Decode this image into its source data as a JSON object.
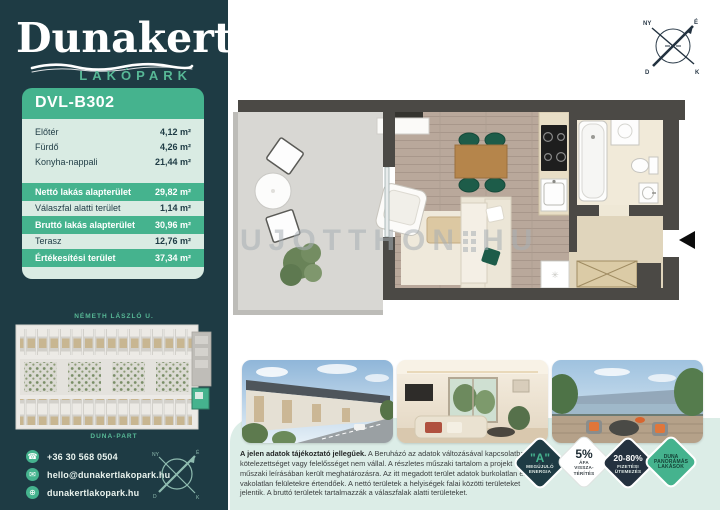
{
  "brand": {
    "name": "Dunakert",
    "subtitle": "LAKÓPARK"
  },
  "unit": {
    "code": "DVL-B302"
  },
  "area_table": {
    "rooms": [
      {
        "label": "Előtér",
        "value": "4,12 m²"
      },
      {
        "label": "Fürdő",
        "value": "4,26 m²"
      },
      {
        "label": "Konyha-nappali",
        "value": "21,44 m²"
      }
    ],
    "summary": [
      {
        "label": "Nettó lakás alapterület",
        "value": "29,82 m²",
        "highlight": true
      },
      {
        "label": "Válaszfal alatti terület",
        "value": "1,14 m²",
        "highlight": false
      },
      {
        "label": "Bruttó lakás alapterület",
        "value": "30,96 m²",
        "highlight": true
      },
      {
        "label": "Terasz",
        "value": "12,76 m²",
        "highlight": false
      },
      {
        "label": "Értékesítési terület",
        "value": "37,34 m²",
        "highlight": true
      }
    ]
  },
  "site_plan": {
    "street_top": "NÉMETH LÁSZLÓ U.",
    "street_bottom": "DUNA-PART"
  },
  "contact": {
    "phone": "+36 30 568 0504",
    "email": "hello@dunakertlakopark.hu",
    "website": "dunakertlakopark.hu"
  },
  "compass": {
    "north": "É",
    "south": "D",
    "east": "K",
    "west": "NY"
  },
  "floor_plan": {
    "watermark": "UJOTTHON",
    "watermark_suffix": "HU"
  },
  "disclaimer": {
    "lead": "A jelen adatok tájékoztató jellegűek.",
    "body": " A Beruházó az adatok változásával kapcsolatban kötelezettséget vagy felelősséget nem vállal. A részletes műszaki tartalom a projekt műszaki leírásában került meghatározásra. Az itt megadott terület adatok burkolatlan és vakolatlan felületekre értendőek. A nettó területek a helyiségek falai közötti területeket jelentik. A bruttó területek tartalmazzák a válaszfalak alatti területeket."
  },
  "badges": [
    {
      "line1": "\"A\"",
      "line2": "MEGÚJULÓ",
      "line3": "ENERGIA"
    },
    {
      "line1": "5%",
      "line2": "ÁFA",
      "line3": "VISSZA-TÉRÍTÉS"
    },
    {
      "line1": "20-80%",
      "line2": "FIZETÉSI",
      "line3": "ÜTEMEZÉS"
    },
    {
      "line1": "DUNA",
      "line2": "PANORÁMÁS",
      "line3": "LAKÁSOK"
    }
  ],
  "colors": {
    "dark_teal": "#1e3b44",
    "green": "#45b38e",
    "mint": "#d9ebe3",
    "navy": "#24313f"
  }
}
